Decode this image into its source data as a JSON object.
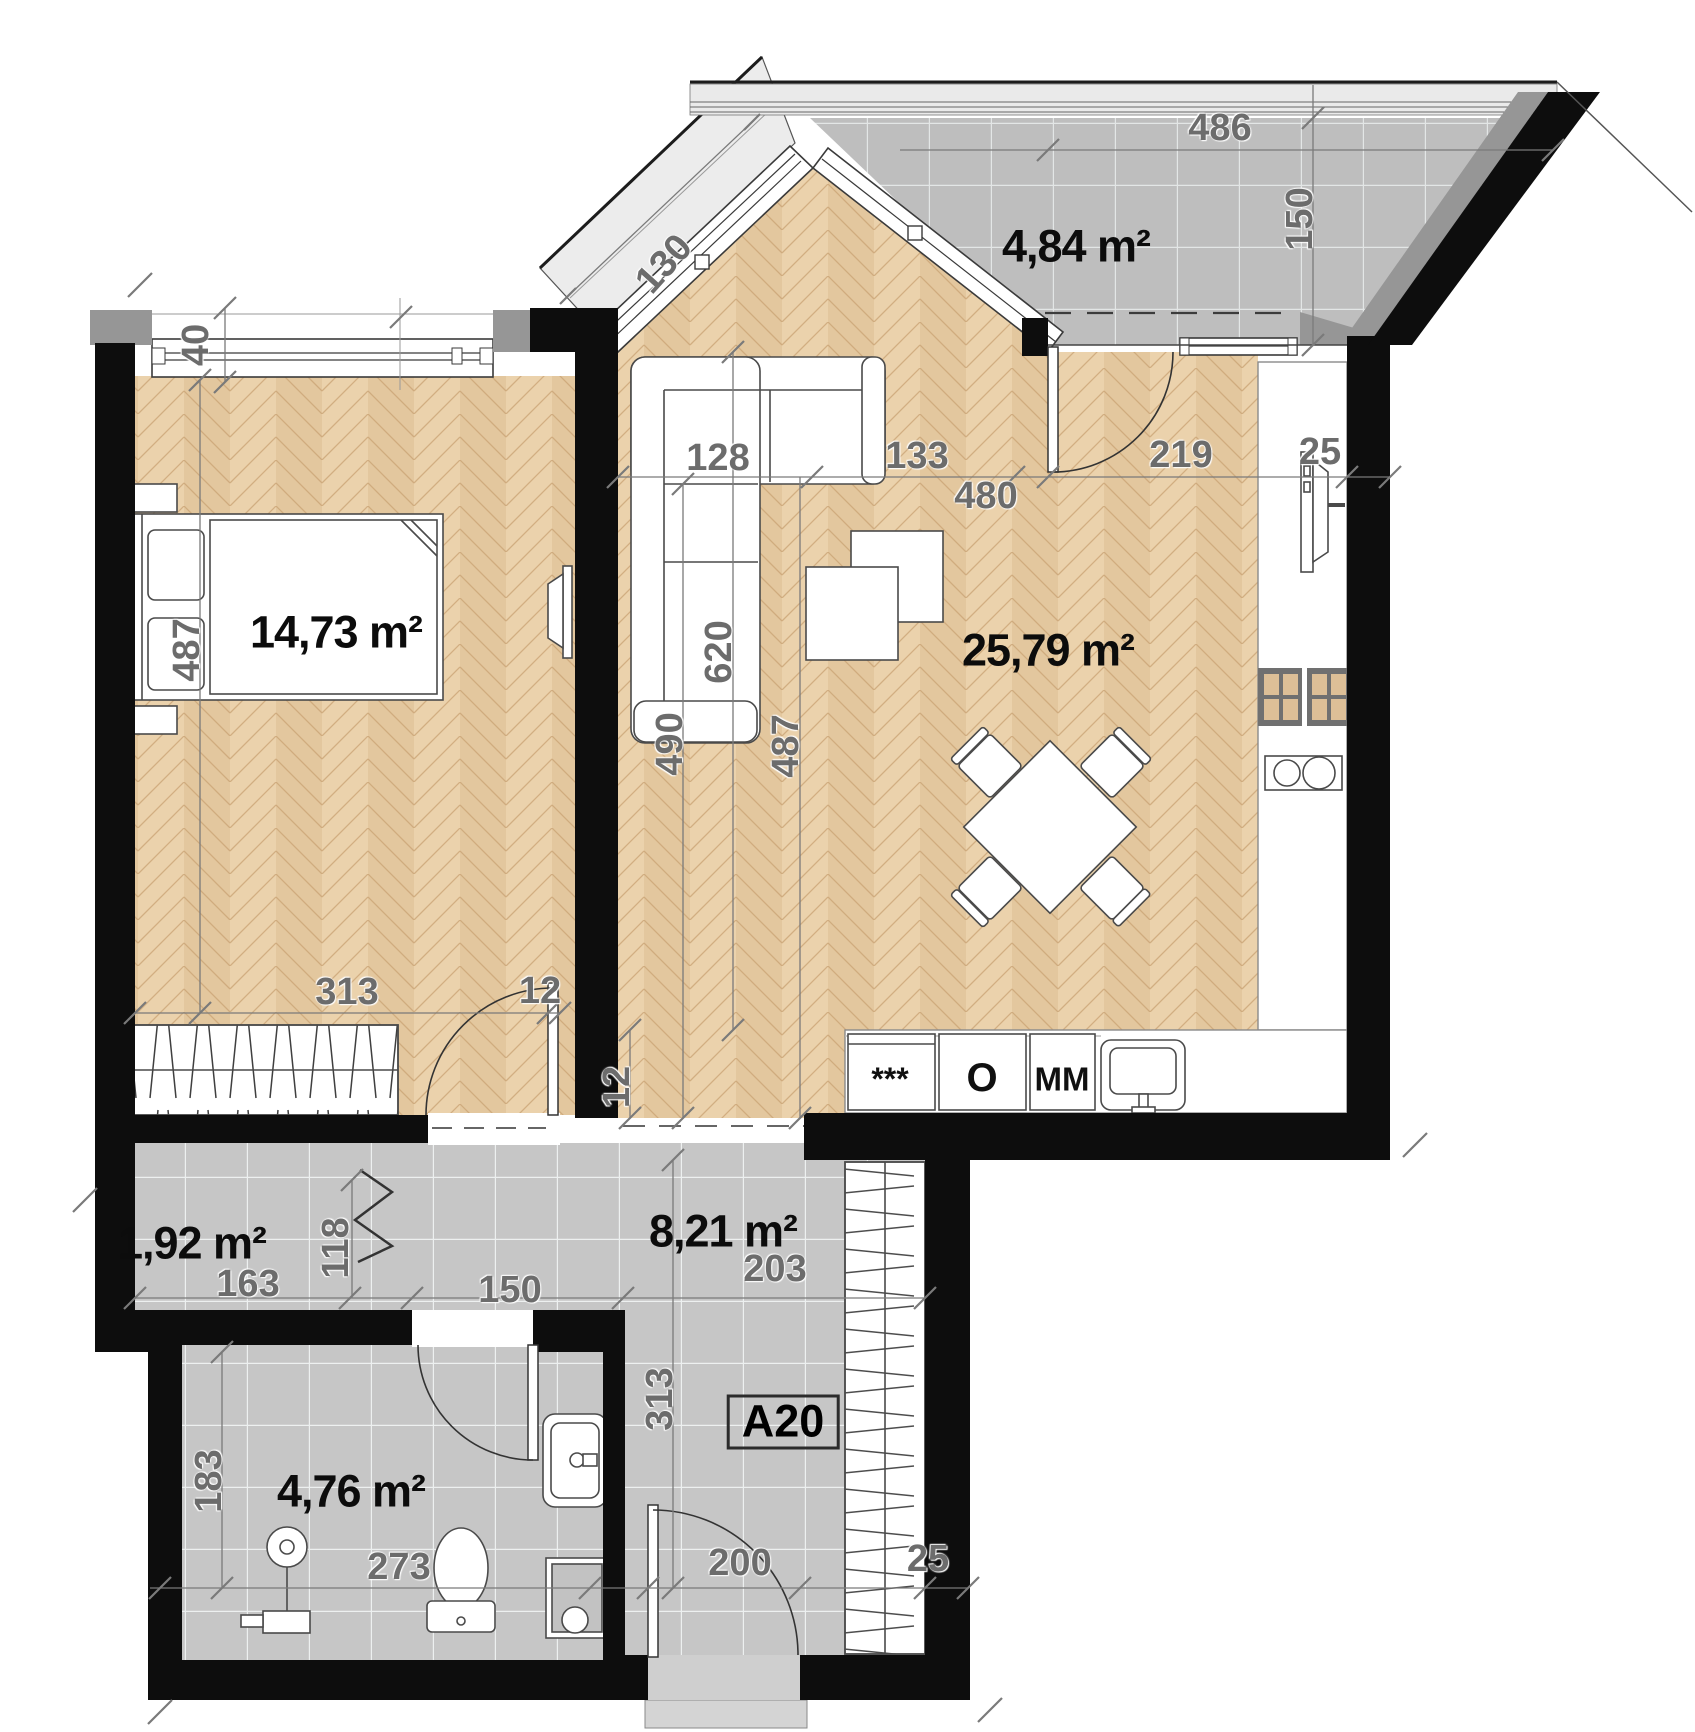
{
  "plan": {
    "unit_tag": "A20",
    "unit_tag_pos": {
      "x": 783,
      "y": 1422
    },
    "colors": {
      "wall": "#0d0d0d",
      "parquet": "#e8cda5",
      "tile": "#c6c6c6",
      "dim_text": "#6c6c6c",
      "accent_gray": "#969696"
    },
    "rooms": [
      {
        "name": "bedroom",
        "area_label": "14,73 m²"
      },
      {
        "name": "living-room-kitchen",
        "area_label": "25,79 m²"
      },
      {
        "name": "balcony",
        "area_label": "4,84 m²"
      },
      {
        "name": "hall",
        "area_label": "1,92 m²"
      },
      {
        "name": "corridor",
        "area_label": "8,21 m²"
      },
      {
        "name": "bathroom",
        "area_label": "4,76 m²"
      }
    ],
    "labels": [
      {
        "name": "area-label-bedroom",
        "cls": "area",
        "text": "14,73 m²",
        "x": 336,
        "y": 632,
        "rot": 0
      },
      {
        "name": "area-label-living",
        "cls": "area",
        "text": "25,79 m²",
        "x": 1048,
        "y": 650,
        "rot": 0
      },
      {
        "name": "area-label-balcony",
        "cls": "area",
        "text": "4,84 m²",
        "x": 1076,
        "y": 246,
        "rot": 0
      },
      {
        "name": "area-label-hall",
        "cls": "area",
        "text": "1,92 m²",
        "x": 192,
        "y": 1243,
        "rot": 0
      },
      {
        "name": "area-label-corridor",
        "cls": "area",
        "text": "8,21 m²",
        "x": 723,
        "y": 1231,
        "rot": 0
      },
      {
        "name": "area-label-bathroom",
        "cls": "area",
        "text": "4,76 m²",
        "x": 351,
        "y": 1491,
        "rot": 0
      },
      {
        "name": "dim-window-40",
        "cls": "dim",
        "text": "40",
        "x": 196,
        "y": 345,
        "rot": -90
      },
      {
        "name": "dim-diag-130",
        "cls": "dim",
        "text": "130",
        "x": 664,
        "y": 264,
        "rot": -48
      },
      {
        "name": "dim-balcony-486",
        "cls": "dim",
        "text": "486",
        "x": 1220,
        "y": 128,
        "rot": 0
      },
      {
        "name": "dim-balcony-150",
        "cls": "dim",
        "text": "150",
        "x": 1300,
        "y": 219,
        "rot": -90
      },
      {
        "name": "dim-living-128",
        "cls": "dim",
        "text": "128",
        "x": 718,
        "y": 458,
        "rot": 0
      },
      {
        "name": "dim-living-133",
        "cls": "dim",
        "text": "133",
        "x": 917,
        "y": 456,
        "rot": 0
      },
      {
        "name": "dim-living-480",
        "cls": "dim",
        "text": "480",
        "x": 986,
        "y": 496,
        "rot": 0
      },
      {
        "name": "dim-living-219",
        "cls": "dim",
        "text": "219",
        "x": 1181,
        "y": 455,
        "rot": 0
      },
      {
        "name": "dim-kitchen-25",
        "cls": "dim",
        "text": "25",
        "x": 1320,
        "y": 452,
        "rot": 0
      },
      {
        "name": "dim-living-620",
        "cls": "dim",
        "text": "620",
        "x": 719,
        "y": 652,
        "rot": -90
      },
      {
        "name": "dim-living-490",
        "cls": "dim",
        "text": "490",
        "x": 670,
        "y": 744,
        "rot": -90
      },
      {
        "name": "dim-living-487",
        "cls": "dim",
        "text": "487",
        "x": 786,
        "y": 746,
        "rot": -90
      },
      {
        "name": "dim-bedroom-487",
        "cls": "dim",
        "text": "487",
        "x": 187,
        "y": 650,
        "rot": -90
      },
      {
        "name": "dim-bedroom-313",
        "cls": "dim",
        "text": "313",
        "x": 347,
        "y": 992,
        "rot": 0
      },
      {
        "name": "dim-bedroom-12",
        "cls": "dim",
        "text": "12",
        "x": 540,
        "y": 991,
        "rot": 0
      },
      {
        "name": "dim-living-12",
        "cls": "dim",
        "text": "12",
        "x": 617,
        "y": 1087,
        "rot": -90
      },
      {
        "name": "dim-hall-163",
        "cls": "dim",
        "text": "163",
        "x": 248,
        "y": 1284,
        "rot": 0
      },
      {
        "name": "dim-hall-118",
        "cls": "dim",
        "text": "118",
        "x": 336,
        "y": 1248,
        "rot": -90
      },
      {
        "name": "dim-hall-150",
        "cls": "dim",
        "text": "150",
        "x": 510,
        "y": 1290,
        "rot": 0
      },
      {
        "name": "dim-corridor-203",
        "cls": "dim",
        "text": "203",
        "x": 775,
        "y": 1269,
        "rot": 0
      },
      {
        "name": "dim-corridor-313",
        "cls": "dim",
        "text": "313",
        "x": 660,
        "y": 1399,
        "rot": -90
      },
      {
        "name": "dim-bathroom-183",
        "cls": "dim",
        "text": "183",
        "x": 209,
        "y": 1481,
        "rot": -90
      },
      {
        "name": "dim-bathroom-273",
        "cls": "dim",
        "text": "273",
        "x": 399,
        "y": 1567,
        "rot": 0
      },
      {
        "name": "dim-entrance-200",
        "cls": "dim",
        "text": "200",
        "x": 740,
        "y": 1563,
        "rot": 0
      },
      {
        "name": "dim-entrance-25",
        "cls": "dim",
        "text": "25",
        "x": 928,
        "y": 1559,
        "rot": 0
      },
      {
        "name": "appliance-label-fridge",
        "cls": "app",
        "text": "***",
        "x": 890,
        "y": 1079,
        "rot": 0,
        "fs": 32
      },
      {
        "name": "appliance-label-oven",
        "cls": "app",
        "text": "O",
        "x": 982,
        "y": 1078,
        "rot": 0,
        "fs": 40
      },
      {
        "name": "appliance-label-microwave",
        "cls": "app",
        "text": "MM",
        "x": 1062,
        "y": 1079,
        "rot": 0,
        "fs": 33
      }
    ]
  }
}
